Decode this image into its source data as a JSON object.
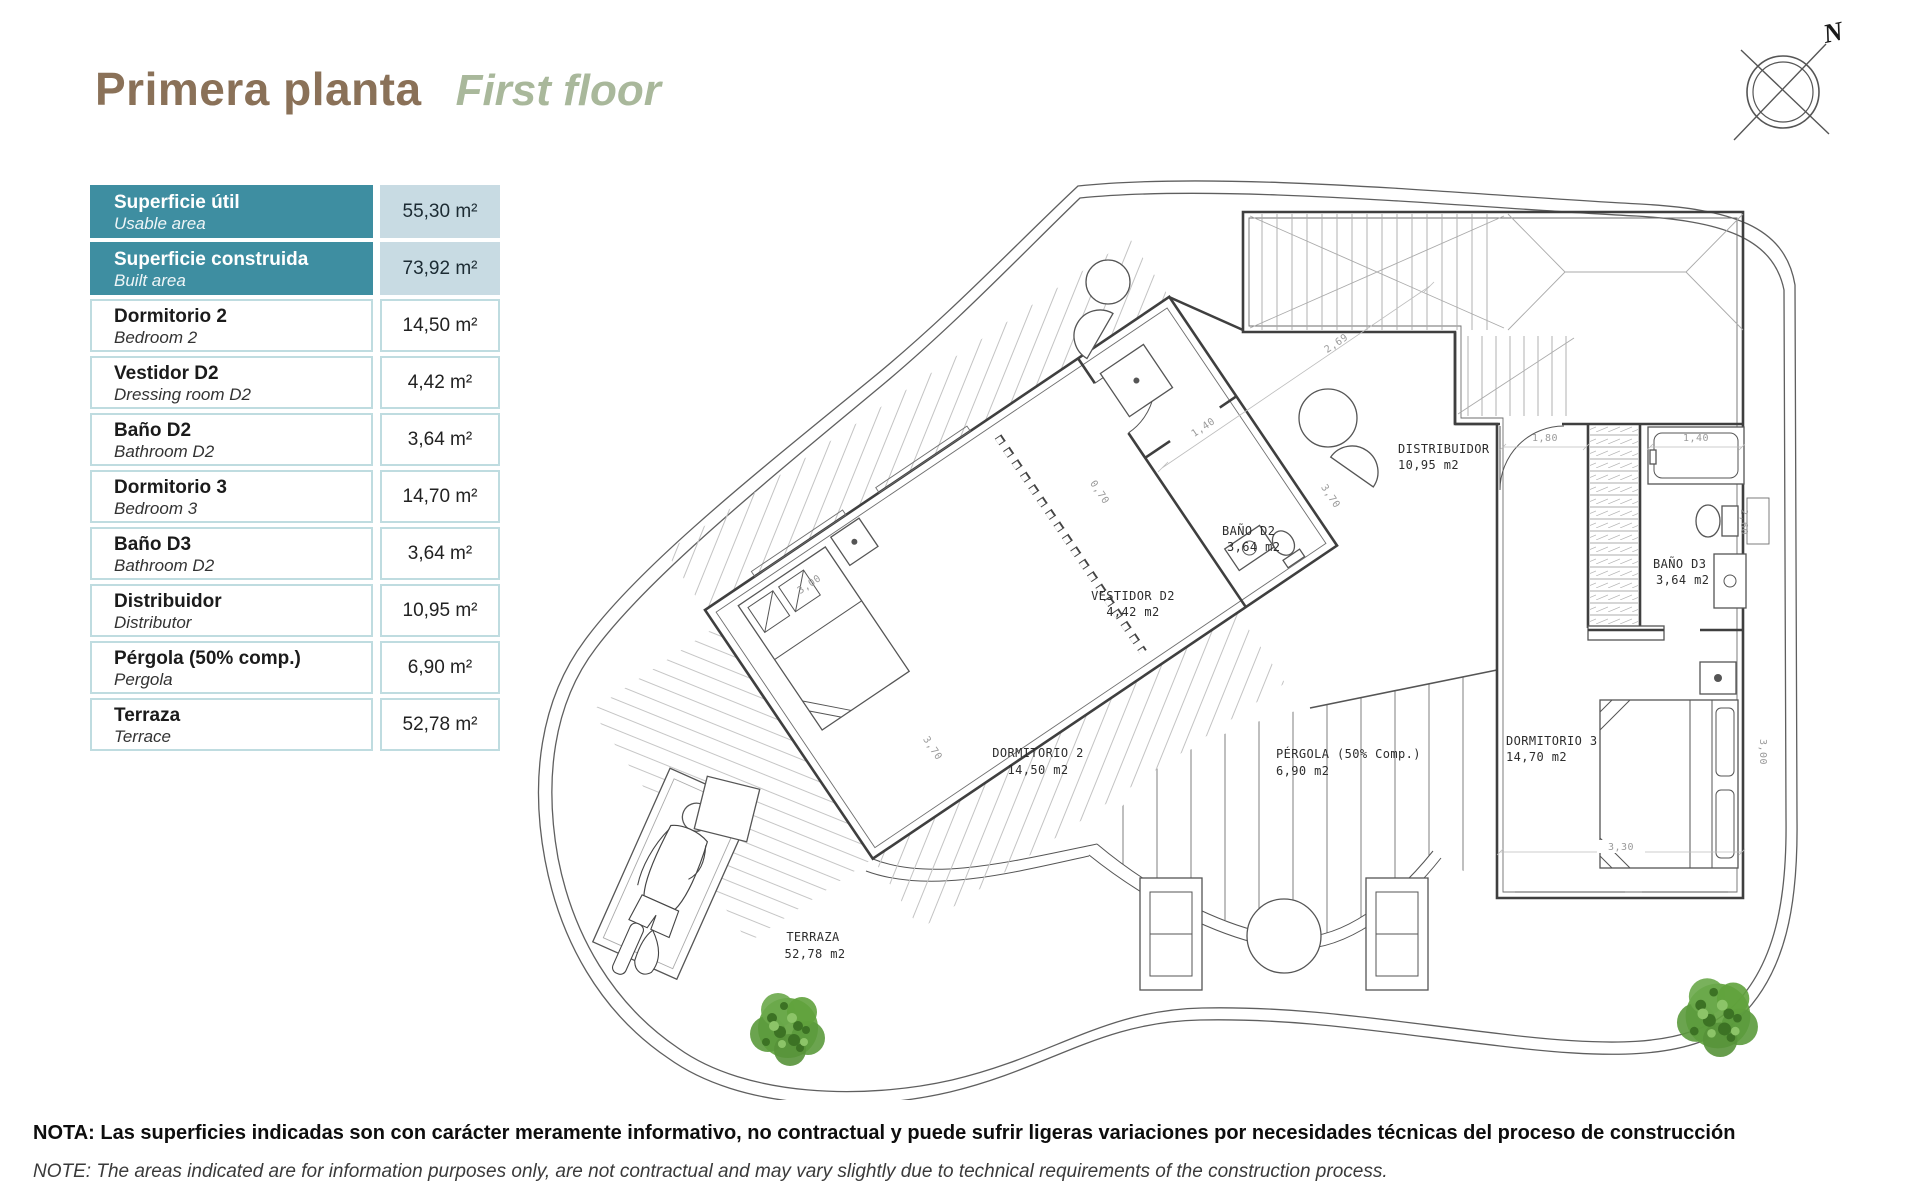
{
  "header": {
    "title_es": "Primera planta",
    "title_en": "First floor"
  },
  "compass": {
    "north": "N"
  },
  "area_table": {
    "rows": [
      {
        "es": "Superficie útil",
        "en": "Usable area",
        "value": "55,30 m²",
        "emphasis": true
      },
      {
        "es": "Superficie construida",
        "en": "Built area",
        "value": "73,92 m²",
        "emphasis": true
      },
      {
        "es": "Dormitorio 2",
        "en": "Bedroom 2",
        "value": "14,50 m²"
      },
      {
        "es": "Vestidor D2",
        "en": "Dressing room D2",
        "value": "4,42 m²"
      },
      {
        "es": "Baño D2",
        "en": "Bathroom D2",
        "value": "3,64 m²"
      },
      {
        "es": "Dormitorio 3",
        "en": "Bedroom 3",
        "value": "14,70 m²"
      },
      {
        "es": "Baño D3",
        "en": "Bathroom D2",
        "value": "3,64 m²"
      },
      {
        "es": "Distribuidor",
        "en": "Distributor",
        "value": "10,95 m²"
      },
      {
        "es": "Pérgola (50% comp.)",
        "en": "Pergola",
        "value": "6,90 m²"
      },
      {
        "es": "Terraza",
        "en": "Terrace",
        "value": "52,78 m²"
      }
    ]
  },
  "floor_plan": {
    "rooms": [
      {
        "name": "DISTRIBUIDOR",
        "area": "10,95 m2"
      },
      {
        "name": "BAÑO D2",
        "area": "3,64 m2"
      },
      {
        "name": "VESTIDOR D2",
        "area": "4,42 m2"
      },
      {
        "name": "DORMITORIO 2",
        "area": "14,50 m2"
      },
      {
        "name": "PÉRGOLA (50% Comp.)",
        "area": "6,90 m2"
      },
      {
        "name": "DORMITORIO 3",
        "area": "14,70 m2"
      },
      {
        "name": "BAÑO D3",
        "area": "3,64 m2"
      },
      {
        "name": "TERRAZA",
        "area": "52,78 m2"
      }
    ],
    "dimensions": [
      "2,69",
      "1,40",
      "0,70",
      "3,00",
      "3,70",
      "3,70",
      "1,80",
      "1,40",
      "2,60",
      "3,00",
      "3,30"
    ]
  },
  "footer": {
    "note_es": "NOTA: Las superficies indicadas son con carácter meramente informativo, no contractual y puede sufrir ligeras variaciones por necesidades técnicas del proceso de construcción",
    "note_en": "NOTE: The areas indicated are for information purposes only, are not contractual and may vary slightly due to technical requirements of the construction process."
  },
  "colors": {
    "accent_teal": "#3E8EA1",
    "accent_light": "#C8DBE3",
    "cell_border": "#BFDCE0",
    "title_brown": "#8A7158",
    "title_sage": "#A9B89B",
    "tree_green": "#5B9A3C"
  }
}
